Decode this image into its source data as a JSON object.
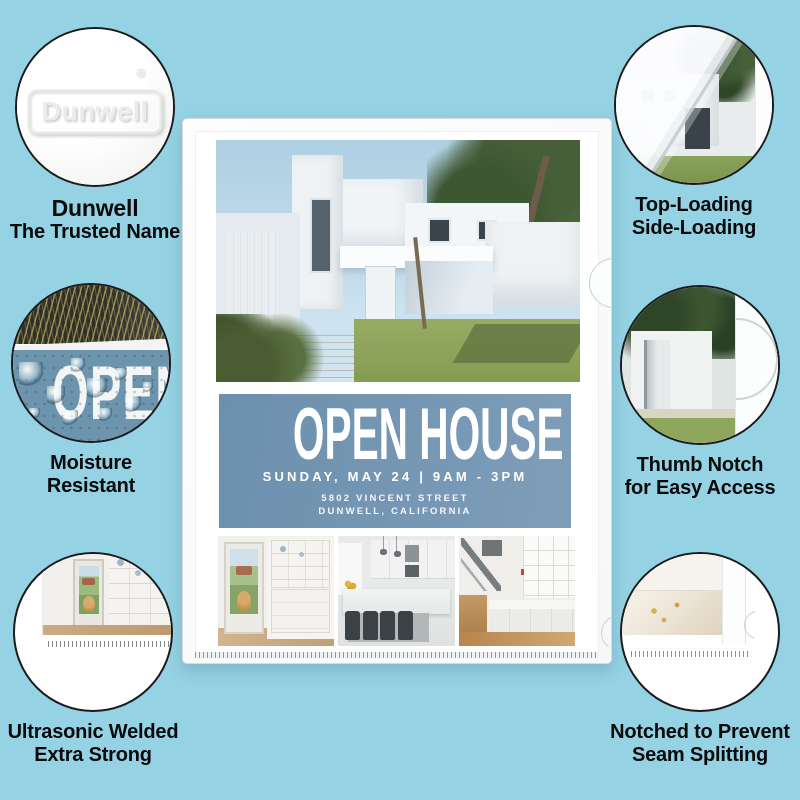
{
  "colors": {
    "page_background": "#95d2e4",
    "flyer_accent": "#7093af",
    "moisture_blue": "#6d94ad",
    "circle_border": "#1a1b1d",
    "label_text": "#0a0a0b"
  },
  "logo": {
    "text": "Dunwell",
    "registered_mark": "®"
  },
  "flyer": {
    "title": "OPEN HOUSE",
    "subtitle": "SUNDAY, MAY 24 | 9AM - 3PM",
    "address_line1": "5802 VINCENT STREET",
    "address_line2": "DUNWELL, CALIFORNIA"
  },
  "moisture_circle": {
    "overlay_text": "OPEN"
  },
  "callouts": {
    "top_left": {
      "line1": "Dunwell",
      "line2": "The Trusted Name"
    },
    "top_right": {
      "line1": "Top-Loading",
      "line2": "Side-Loading"
    },
    "mid_left": {
      "line1": "Moisture",
      "line2": "Resistant"
    },
    "mid_right": {
      "line1": "Thumb Notch",
      "line2": "for Easy Access"
    },
    "bottom_left": {
      "line1": "Ultrasonic Welded",
      "line2": "Extra Strong"
    },
    "bottom_right": {
      "line1": "Notched to Prevent",
      "line2": "Seam Splitting"
    }
  }
}
